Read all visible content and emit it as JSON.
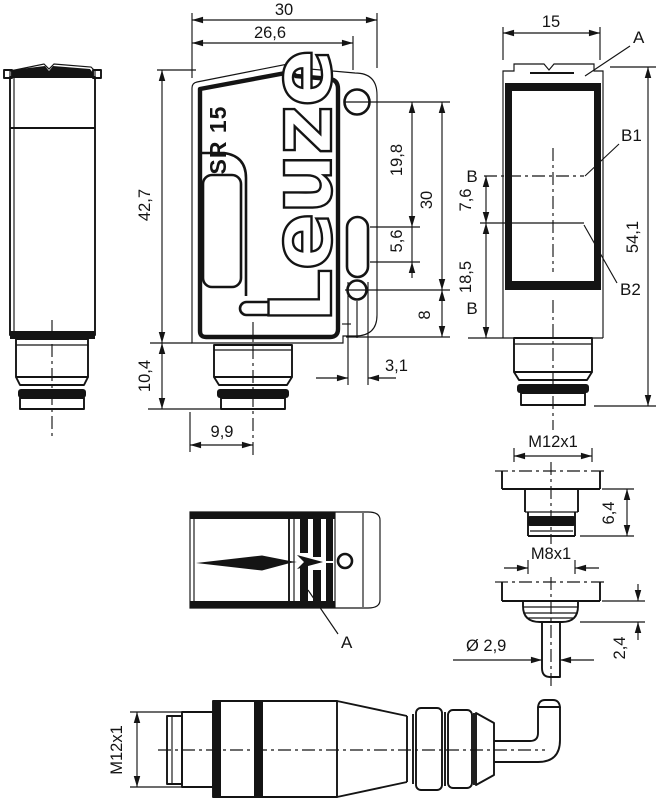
{
  "branding": {
    "model": "SR 15",
    "logo": "Leuze"
  },
  "labels": {
    "optical_face_side": "A",
    "optical_face_top": "A",
    "axis_b_upper": "B",
    "axis_b_lower": "B",
    "axis_b1": "B1",
    "axis_b2": "B2"
  },
  "dims": {
    "overall_width": "30",
    "face_width": "26,6",
    "body_height": "42,7",
    "depth": "15",
    "hole_to_slot": "19,8",
    "hole_spacing": "30",
    "slot_length": "5,6",
    "lower_hole_to_bottom": "8",
    "slot_width": "3,1",
    "connector_height": "10,4",
    "connector_offset": "9,9",
    "axis_offset": "7,6",
    "axis_to_bottom": "18,5",
    "total_height": "54,1",
    "m12_connector": "M12x1",
    "m8_length": "6,4",
    "m8_connector": "M8x1",
    "cable_diameter": "Ø 2,9",
    "grommet_height": "2,4",
    "plug_thread": "M12x1"
  },
  "colors": {
    "line": "#141414",
    "background": "#ffffff"
  }
}
